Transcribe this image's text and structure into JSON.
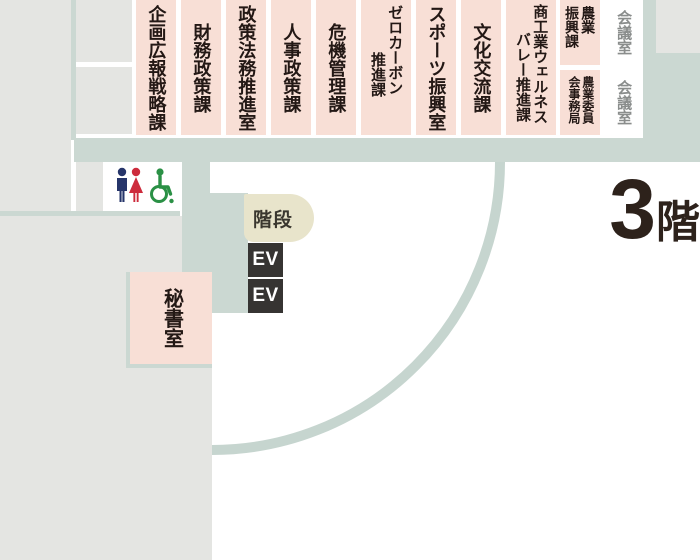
{
  "floor": {
    "number": "3",
    "suffix": "階"
  },
  "top_rooms": [
    {
      "id": "planning-pr-strategy",
      "cols": [
        "企画広報戦略課"
      ]
    },
    {
      "id": "finance-policy",
      "cols": [
        "財務政策課"
      ]
    },
    {
      "id": "policy-legal-promotion",
      "cols": [
        "政策法務推進室"
      ]
    },
    {
      "id": "hr-policy",
      "cols": [
        "人事政策課"
      ]
    },
    {
      "id": "crisis-management",
      "cols": [
        "危機管理課"
      ]
    },
    {
      "id": "zero-carbon-promotion",
      "cols": [
        "ゼロカーボン",
        "推進課"
      ]
    },
    {
      "id": "sports-promotion",
      "cols": [
        "スポーツ振興室"
      ]
    },
    {
      "id": "cultural-exchange",
      "cols": [
        "文化交流課"
      ]
    },
    {
      "id": "commerce-wellness-valley",
      "cols": [
        "商工業ウェルネス",
        "バレー推進課"
      ]
    },
    {
      "id": "agriculture-promotion",
      "cols": [
        "農業",
        "振興課"
      ]
    },
    {
      "id": "agricultural-committee",
      "cols": [
        "農業委員",
        "会事務局"
      ]
    },
    {
      "id": "meeting-room-1",
      "cols": [
        "会議室"
      ]
    },
    {
      "id": "meeting-room-2",
      "cols": [
        "会議室"
      ]
    }
  ],
  "other_rooms": {
    "secretary": "秘書室"
  },
  "facilities": {
    "stairs": "階段",
    "elevators": [
      "EV",
      "EV"
    ]
  },
  "icons": [
    "men-restroom-icon",
    "women-restroom-icon",
    "wheelchair-accessible-icon"
  ],
  "colors": {
    "room_pink": "#f8dfd6",
    "wall_green": "#cbd8d2",
    "area_gray": "#e4e5e2",
    "stairs_beige": "#e8e4cb",
    "elevator_dark": "#363432",
    "label_text": "#231815",
    "meeting_room_text": "#8a8d8c",
    "floor_text": "#2d221b",
    "icon_man_navy": "#26356a",
    "icon_woman_red": "#cd2b3c",
    "icon_wheelchair_green": "#2a9045"
  }
}
